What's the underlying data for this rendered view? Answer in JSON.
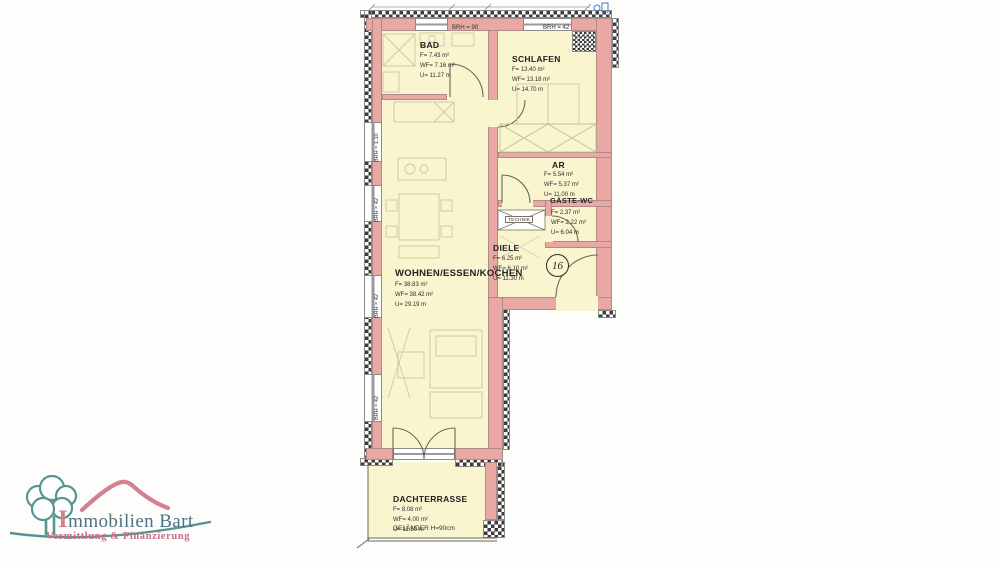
{
  "plan": {
    "unit_number": "16",
    "rooms": {
      "bad": {
        "name": "BAD",
        "f": "F= 7.43 m²",
        "wf": "WF= 7.16 m²",
        "u": "U= 11.27 m"
      },
      "schlafen": {
        "name": "SCHLAFEN",
        "f": "F= 13.40 m²",
        "wf": "WF= 13.18 m²",
        "u": "U= 14.70 m"
      },
      "abstellraum": {
        "name": "AR",
        "f": "F= 5.54 m²",
        "wf": "WF= 5.37 m²",
        "u": "U= 11.00 m"
      },
      "gaeste_wc": {
        "name": "GÄSTE-WC",
        "f": "F= 2.37 m²",
        "wf": "WF= 2.22 m²",
        "u": "U= 6.04 m"
      },
      "diele": {
        "name": "DIELE",
        "f": "F= 6.25 m²",
        "wf": "WF= 6.10 m²",
        "u": "U= 11.30 m"
      },
      "wohnen": {
        "name": "WOHNEN/ESSEN/KOCHEN",
        "f": "F= 38.83 m²",
        "wf": "WF= 38.42 m²",
        "u": "U= 29.19 m"
      },
      "dachterrasse": {
        "name": "DACHTERRASSE",
        "f": "F= 8.08 m²",
        "wf": "WF= 4.00 m²",
        "u": "U= 11.80 m"
      }
    },
    "labels": {
      "technik": "TECHNIK",
      "gelaender": "GELÄNDER H=90cm",
      "brh_top_left": "BRH = 90",
      "brh_top_right": "BRH = 42",
      "brh_left_1": "BRH = 1.10",
      "brh_left_2": "BRH = 42",
      "brh_left_3": "BRH = 42",
      "brh_left_4": "BRH = 42"
    },
    "colors": {
      "wall": "#e9a8a3",
      "room_fill": "#f8f5cf"
    }
  },
  "logo": {
    "brand": "Immobilien Bart",
    "tagline": "Vermittlung & Finanzierung",
    "colors": {
      "teal": "#579490",
      "pink": "#d4808f",
      "slate": "#4c7282"
    }
  }
}
